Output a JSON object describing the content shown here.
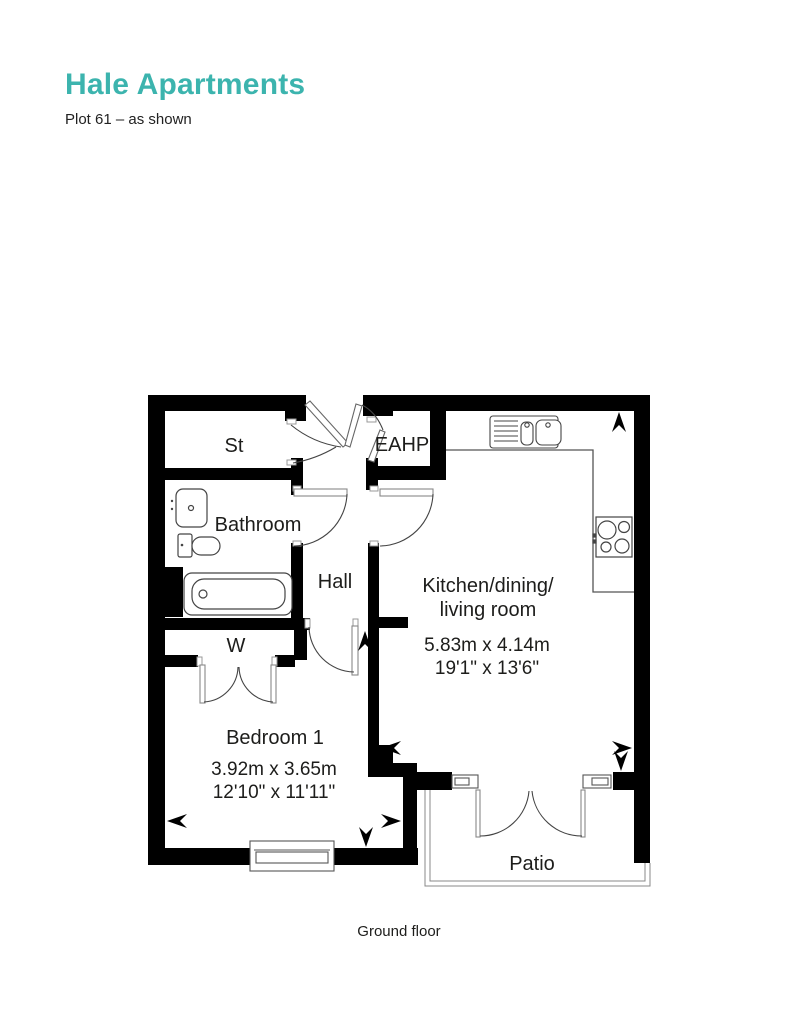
{
  "header": {
    "title": "Hale Apartments",
    "subtitle": "Plot 61 – as shown"
  },
  "plan": {
    "floor_label": "Ground floor",
    "rooms": {
      "st": {
        "label": "St"
      },
      "eahp": {
        "label": "EAHP"
      },
      "bathroom": {
        "label": "Bathroom"
      },
      "hall": {
        "label": "Hall"
      },
      "wardrobe": {
        "label": "W"
      },
      "bedroom": {
        "name": "Bedroom 1",
        "metric": "3.92m x 3.65m",
        "imperial": "12'10\" x 11'11\""
      },
      "kitchen": {
        "name_line1": "Kitchen/dining/",
        "name_line2": "living room",
        "metric": "5.83m x 4.14m",
        "imperial": "19'1\" x 13'6\""
      },
      "patio": {
        "label": "Patio"
      }
    },
    "fixtures": [
      "kitchen-sink",
      "hob",
      "bathtub",
      "washbasin",
      "toilet"
    ],
    "colors": {
      "accent": "#3CB4AE",
      "wall": "#000000",
      "text": "#1D1D1B"
    }
  }
}
